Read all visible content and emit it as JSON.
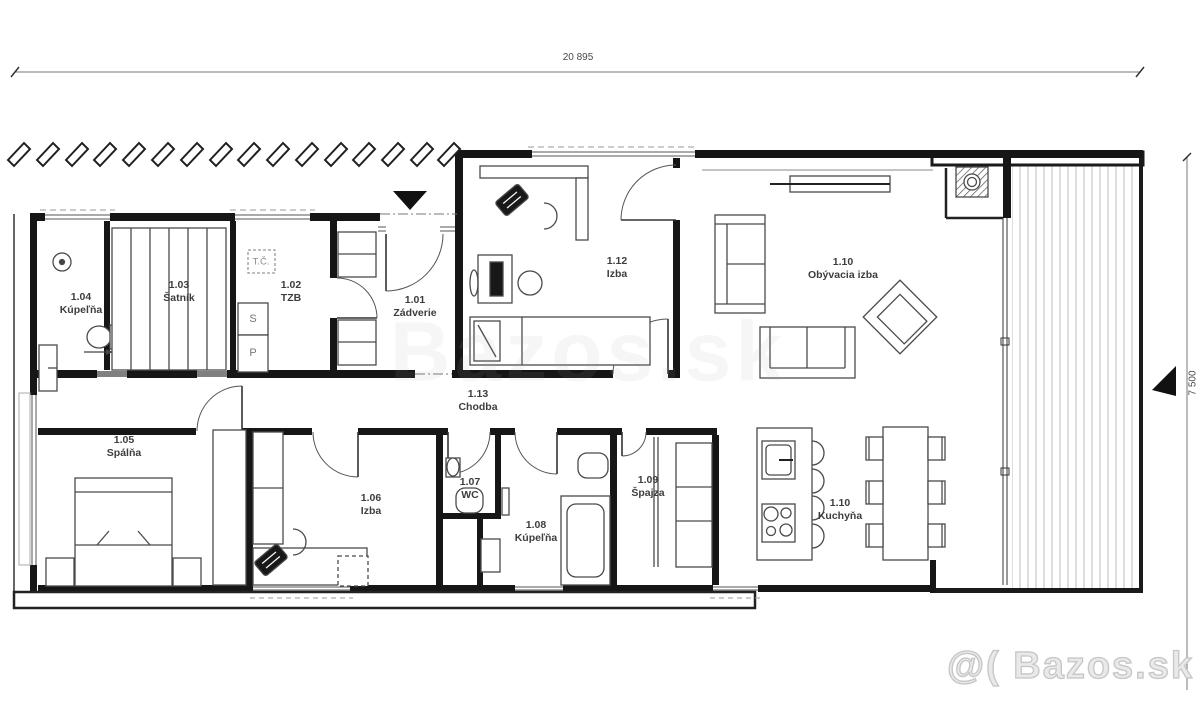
{
  "drawing": {
    "dimension_top": "20 895",
    "dimension_right": "7 500"
  },
  "rooms": [
    {
      "id": "1.04",
      "name": "Kúpeľňa"
    },
    {
      "id": "1.03",
      "name": "Šatník"
    },
    {
      "id": "1.02",
      "name": "TZB"
    },
    {
      "id": "1.01",
      "name": "Zádverie"
    },
    {
      "id": "1.12",
      "name": "Izba"
    },
    {
      "id": "1.10",
      "name": "Obývacia izba"
    },
    {
      "id": "1.13",
      "name": "Chodba"
    },
    {
      "id": "1.05",
      "name": "Spálňa"
    },
    {
      "id": "1.06",
      "name": "Izba"
    },
    {
      "id": "1.07",
      "name": "WC"
    },
    {
      "id": "1.08",
      "name": "Kúpeľňa"
    },
    {
      "id": "1.09",
      "name": "Špajza"
    },
    {
      "id": "1.10b",
      "name": "Kuchyňa",
      "id_display": "1.10"
    },
    {
      "id": "1.10c"
    }
  ],
  "annotations": {
    "tc": "T.Č.",
    "s": "S",
    "p": "P"
  },
  "watermark": "@( Bazos.sk",
  "watermark_center": "Bazos.sk"
}
